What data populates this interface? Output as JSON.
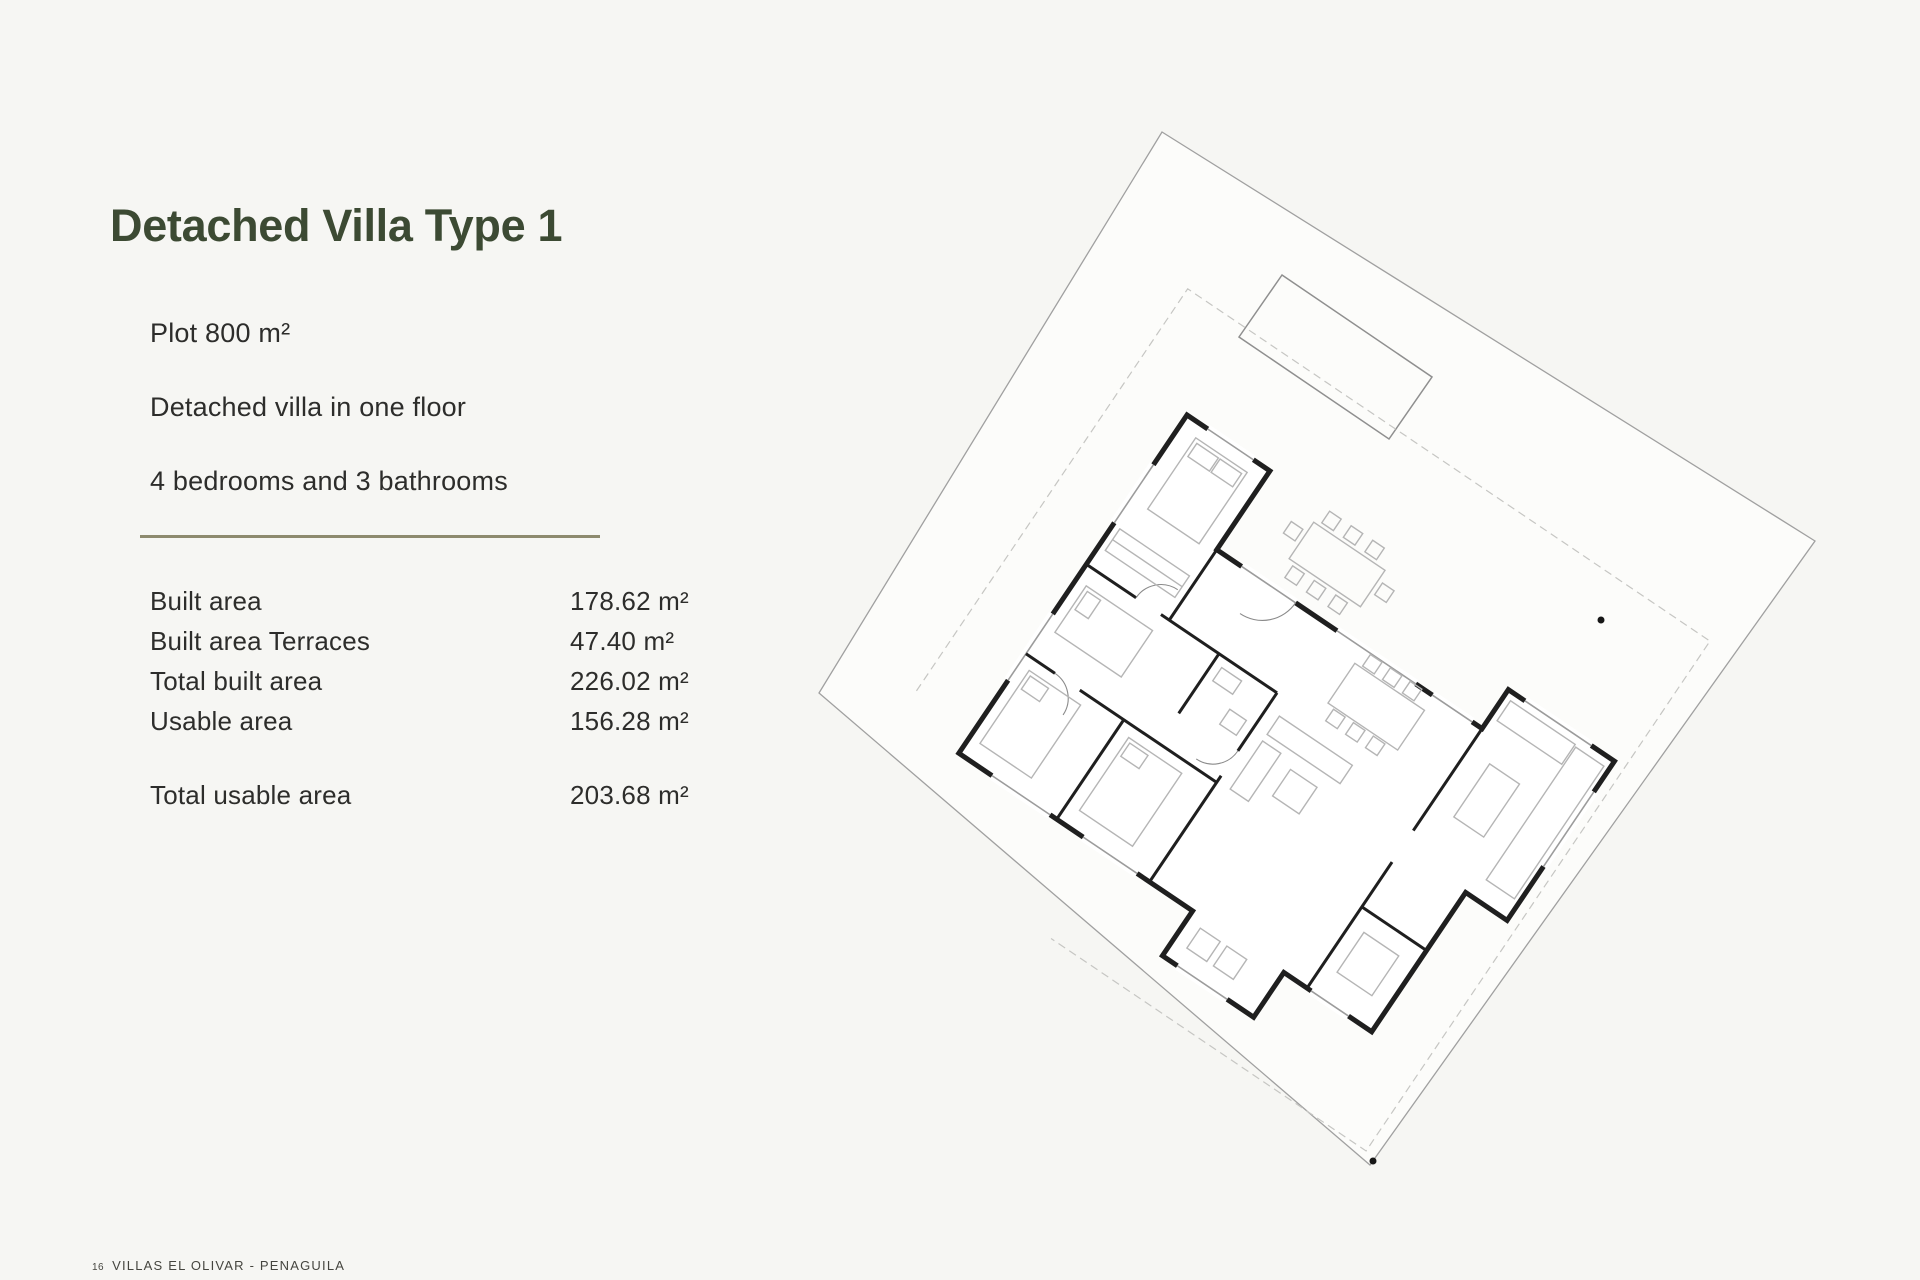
{
  "page": {
    "title": "Detached Villa Type 1",
    "specs": [
      "Plot 800 m²",
      "Detached villa in one floor",
      "4 bedrooms and 3 bathrooms"
    ],
    "areas": [
      {
        "label": "Built area",
        "value": "178.62 m²"
      },
      {
        "label": "Built area Terraces",
        "value": "47.40 m²"
      },
      {
        "label": "Total built area",
        "value": "226.02 m²"
      },
      {
        "label": "Usable area",
        "value": "156.28 m²"
      }
    ],
    "total": {
      "label": "Total usable area",
      "value": "203.68 m²"
    },
    "footer": {
      "page_number": "16",
      "text": "VILLAS EL OLIVAR - PENAGUILA"
    },
    "colors": {
      "background": "#f6f6f3",
      "title_green": "#3c4a33",
      "divider_olive": "#8d8a6e",
      "wall_black": "#1f1f1f",
      "plot_line_gray": "#a0a0a0",
      "furniture_gray": "#b5b5b5"
    },
    "floorplan": {
      "description": "site-plan-rotated-villa-floorplan-with-pool"
    }
  }
}
